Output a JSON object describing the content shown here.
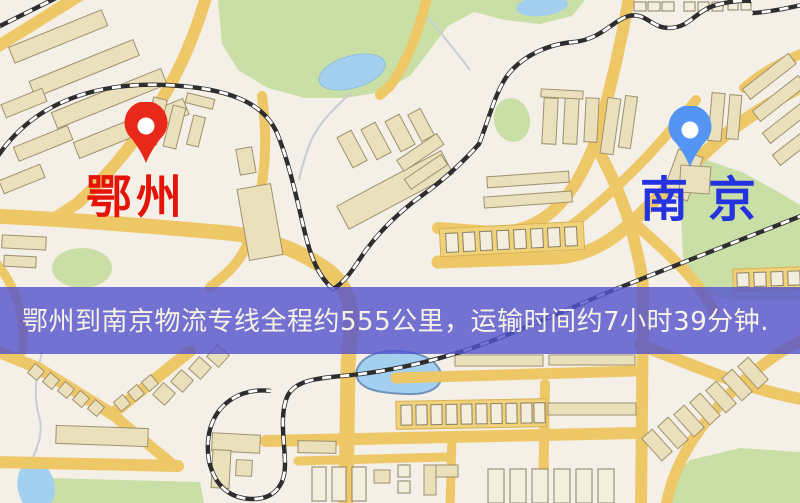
{
  "page": {
    "width": 800,
    "height": 503
  },
  "map": {
    "origin": {
      "label": "鄂州",
      "pin_color": "#e8291a",
      "label_color": "#e41408"
    },
    "destination": {
      "label": "南京",
      "pin_color": "#5494f2",
      "label_color": "#2433e0"
    },
    "banner": {
      "text": "鄂州到南京物流专线全程约555公里，运输时间约7小时39分钟.",
      "distance_text": "约555公里",
      "duration_text": "约7小时39分钟",
      "bg_color": "rgba(82,82,206,0.8)",
      "text_color": "#f6f3e6"
    },
    "palette": {
      "base": "#f4efe7",
      "road": "#eec767",
      "building": "#eae0bc",
      "building_outline": "#a0916e",
      "green": "#cadfa5",
      "water": "#a3d0ee",
      "rail": "#2e2e2e"
    }
  }
}
